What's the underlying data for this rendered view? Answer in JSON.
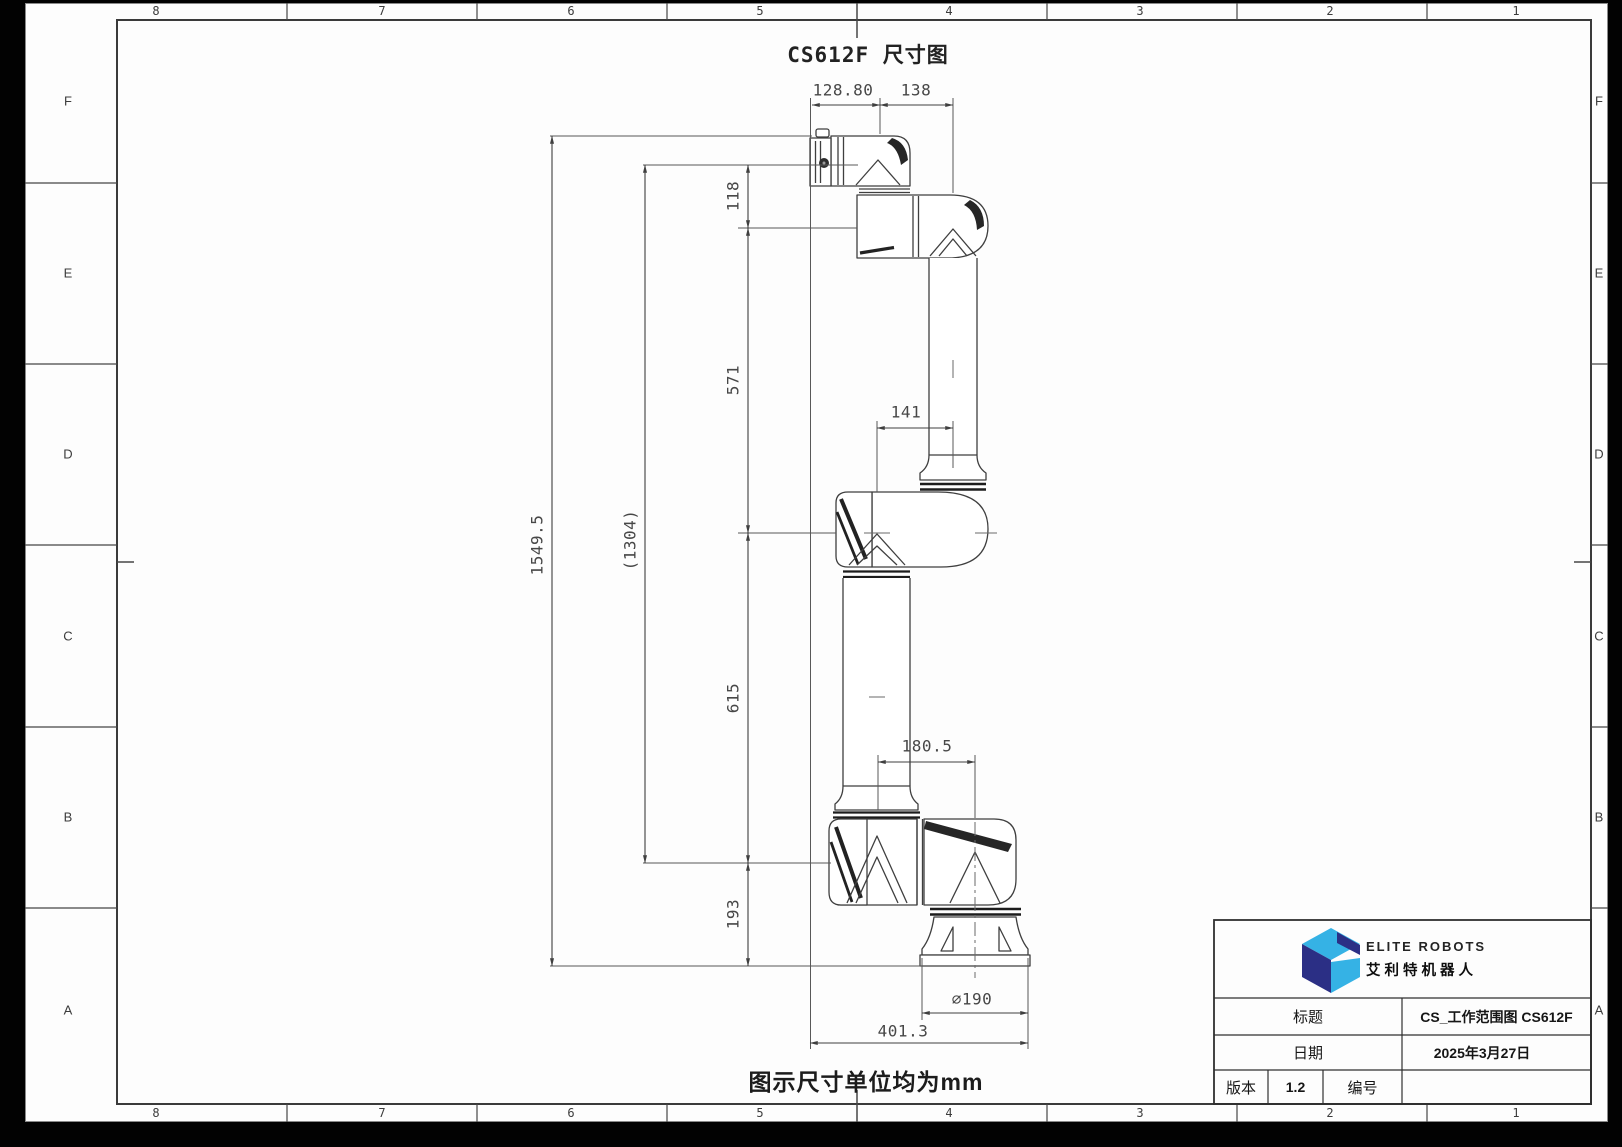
{
  "drawing": {
    "title": "CS612F 尺寸图",
    "note": "图示尺寸单位均为mm",
    "dimensions": {
      "wrist_reach": "128.80",
      "wrist_offset": "138",
      "flange_to_wrist": "118",
      "forearm_length": "571",
      "elbow_offset": "141",
      "upper_arm_length": "615",
      "shoulder_offset": "180.5",
      "base_height": "193",
      "overall_height": "1549.5",
      "ref_height": "(1304)",
      "base_diameter": "∅190",
      "footprint_width": "401.3"
    }
  },
  "zones": {
    "columns": [
      "8",
      "7",
      "6",
      "5",
      "4",
      "3",
      "2",
      "1"
    ],
    "rows": [
      "F",
      "E",
      "D",
      "C",
      "B",
      "A"
    ]
  },
  "title_block": {
    "brand_en": "ELITE ROBOTS",
    "brand_cn": "艾利特机器人",
    "fields": {
      "title_label": "标题",
      "title_value": "CS_工作范围图 CS612F",
      "date_label": "日期",
      "date_value": "2025年3月27日",
      "version_label": "版本",
      "version_value": "1.2",
      "number_label": "编号",
      "number_value": ""
    }
  },
  "colors": {
    "logo_light_blue": "#35b2e5",
    "logo_navy": "#2b2f85",
    "line": "#3d3d3d"
  }
}
